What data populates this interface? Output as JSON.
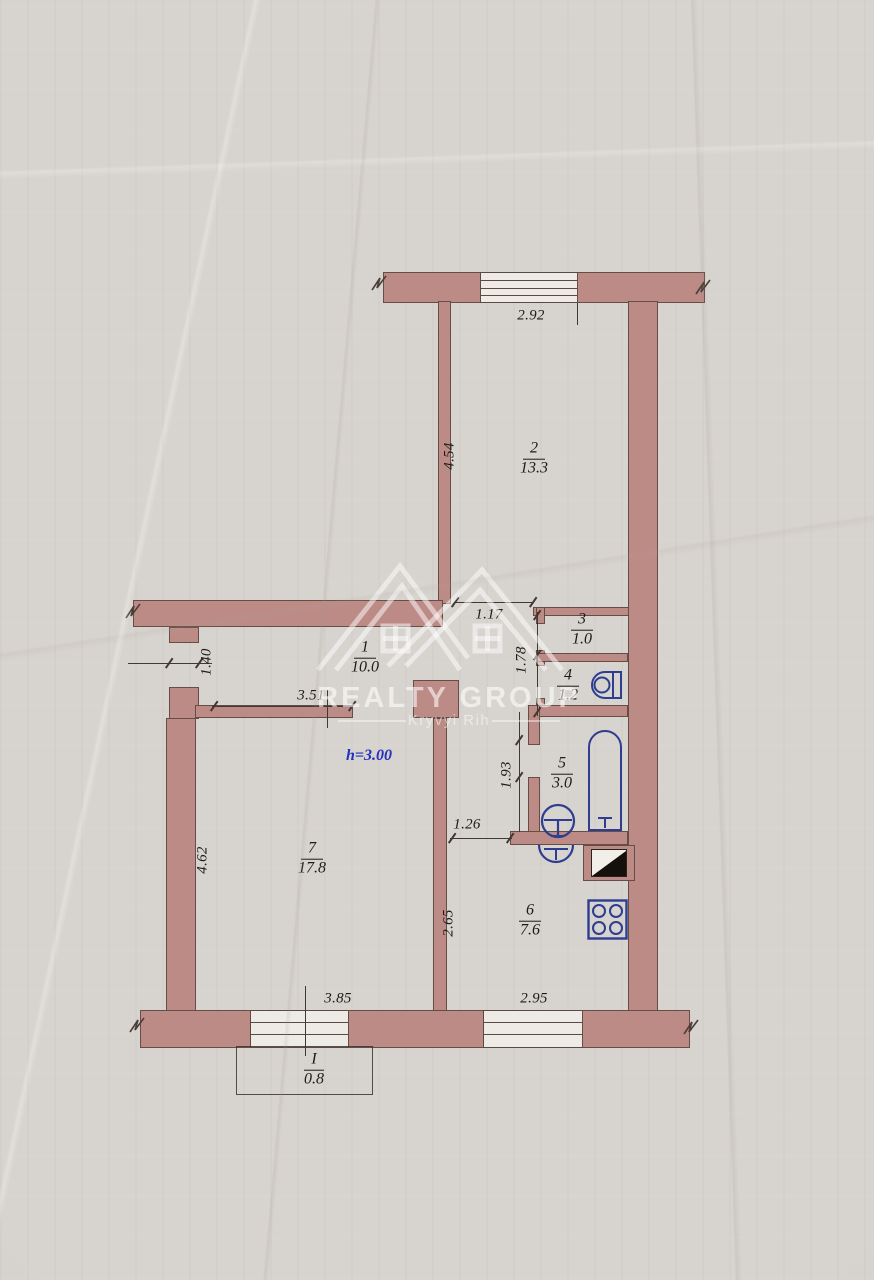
{
  "watermark": {
    "brand": "REALTY GROUP",
    "city": "Kryvyi Rih"
  },
  "plan": {
    "ceiling_height": "h=3.00",
    "rooms": [
      {
        "number": "1",
        "area": "10.0"
      },
      {
        "number": "2",
        "area": "13.3"
      },
      {
        "number": "3",
        "area": "1.0"
      },
      {
        "number": "4",
        "area": "1.2"
      },
      {
        "number": "5",
        "area": "3.0"
      },
      {
        "number": "6",
        "area": "7.6"
      },
      {
        "number": "7",
        "area": "17.8"
      },
      {
        "number": "I",
        "area": "0.8"
      }
    ],
    "dimensions": [
      {
        "value": "2.92"
      },
      {
        "value": "4.54"
      },
      {
        "value": "1.17"
      },
      {
        "value": "1.40"
      },
      {
        "value": "3.51"
      },
      {
        "value": "1.78"
      },
      {
        "value": "1.93"
      },
      {
        "value": "1.26"
      },
      {
        "value": "2.65"
      },
      {
        "value": "2.95"
      },
      {
        "value": "3.85"
      },
      {
        "value": "4.62"
      }
    ],
    "fixtures": [
      "toilet",
      "bathtub",
      "washbasin",
      "kitchen-sink",
      "stove",
      "ventilation-shaft"
    ]
  },
  "colors": {
    "paper": "#d7d3ce",
    "wall_fill": "#bd8b86",
    "wall_line": "#5a4a42",
    "line_dark": "#3f3833",
    "fixture_blue": "#2e3d8f",
    "text_dark": "#1d1a18",
    "blue_text": "#2431c0",
    "vent_black": "#16100c",
    "window_white": "#eeebe6"
  }
}
